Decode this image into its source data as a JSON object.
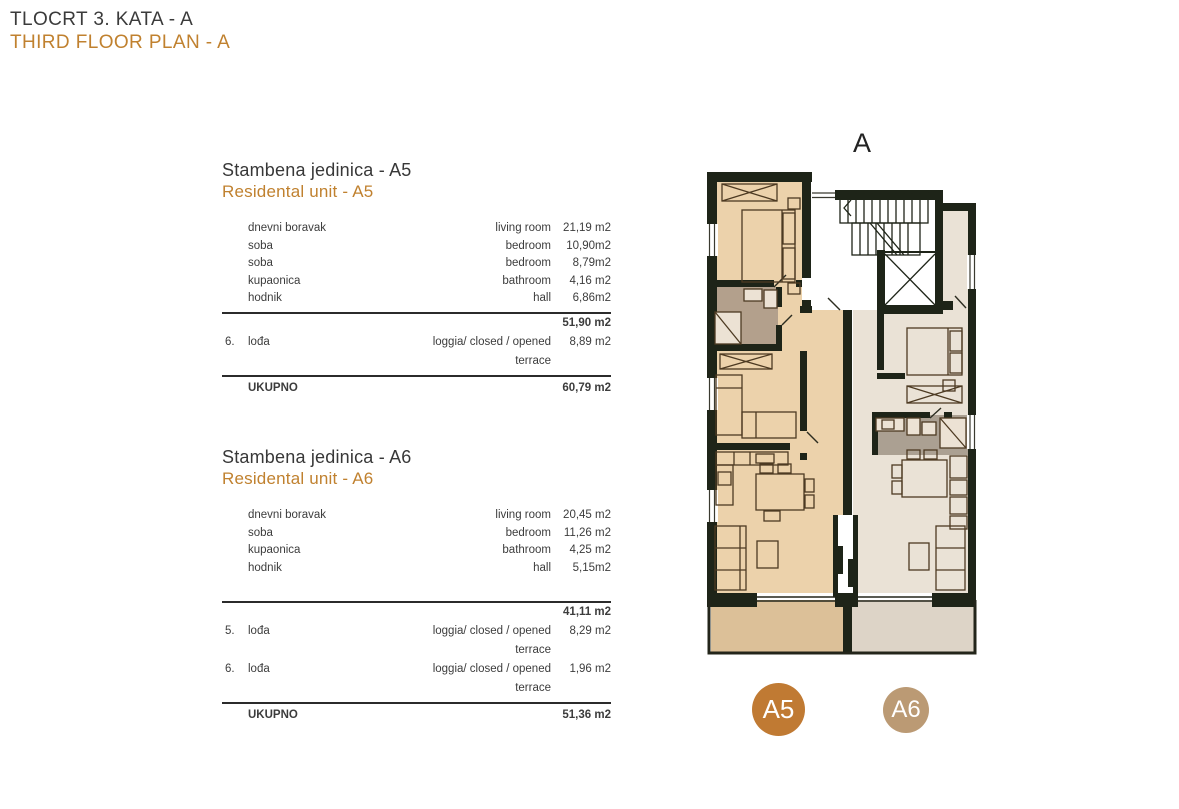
{
  "header": {
    "title_hr": "TLOCRT 3. KATA - A",
    "title_en": "THIRD FLOOR PLAN - A"
  },
  "units": [
    {
      "id": "A5",
      "title_hr": "Stambena jedinica - A5",
      "title_en": "Residental unit - A5",
      "rooms": [
        {
          "hr": "dnevni boravak",
          "en": "living room",
          "val": "21,19 m2"
        },
        {
          "hr": "soba",
          "en": "bedroom",
          "val": "10,90m2"
        },
        {
          "hr": "soba",
          "en": "bedroom",
          "val": "8,79m2"
        },
        {
          "hr": "kupaonica",
          "en": "bathroom",
          "val": "4,16 m2"
        },
        {
          "hr": "hodnik",
          "en": "hall",
          "val": "6,86m2"
        }
      ],
      "subtotal": "51,90 m2",
      "loggias": [
        {
          "num": "6.",
          "hr": "lođa",
          "en": "loggia/ closed / opened terrace",
          "val": "8,89 m2"
        }
      ],
      "total_label": "UKUPNO",
      "total": "60,79 m2"
    },
    {
      "id": "A6",
      "title_hr": "Stambena jedinica - A6",
      "title_en": "Residental unit - A6",
      "rooms": [
        {
          "hr": "dnevni boravak",
          "en": "living room",
          "val": "20,45 m2"
        },
        {
          "hr": "soba",
          "en": "bedroom",
          "val": "11,26 m2"
        },
        {
          "hr": "kupaonica",
          "en": "bathroom",
          "val": "4,25 m2"
        },
        {
          "hr": "hodnik",
          "en": "hall",
          "val": "5,15m2"
        }
      ],
      "subtotal": "41,11 m2",
      "loggias": [
        {
          "num": "5.",
          "hr": "lođa",
          "en": "loggia/ closed / opened terrace",
          "val": "8,29 m2"
        },
        {
          "num": "6.",
          "hr": "lođa",
          "en": "loggia/ closed / opened terrace",
          "val": "1,96 m2"
        }
      ],
      "total_label": "UKUPNO",
      "total": "51,36 m2"
    }
  ],
  "plan": {
    "block_label": "A",
    "badges": [
      {
        "label": "A5",
        "color": "#c07a33"
      },
      {
        "label": "A6",
        "color": "#bb9a74"
      }
    ],
    "colors": {
      "accent": "#c0812f",
      "text_dark": "#3c3c3c",
      "wall": "#1e2418",
      "a5_fill": "#ecd2ab",
      "a6_fill": "#eae2d6",
      "a5_bath": "#b3a08c",
      "a6_bath": "#aba092",
      "a5_loggia": "#dcc098",
      "a6_loggia": "#ddd4c7"
    }
  }
}
